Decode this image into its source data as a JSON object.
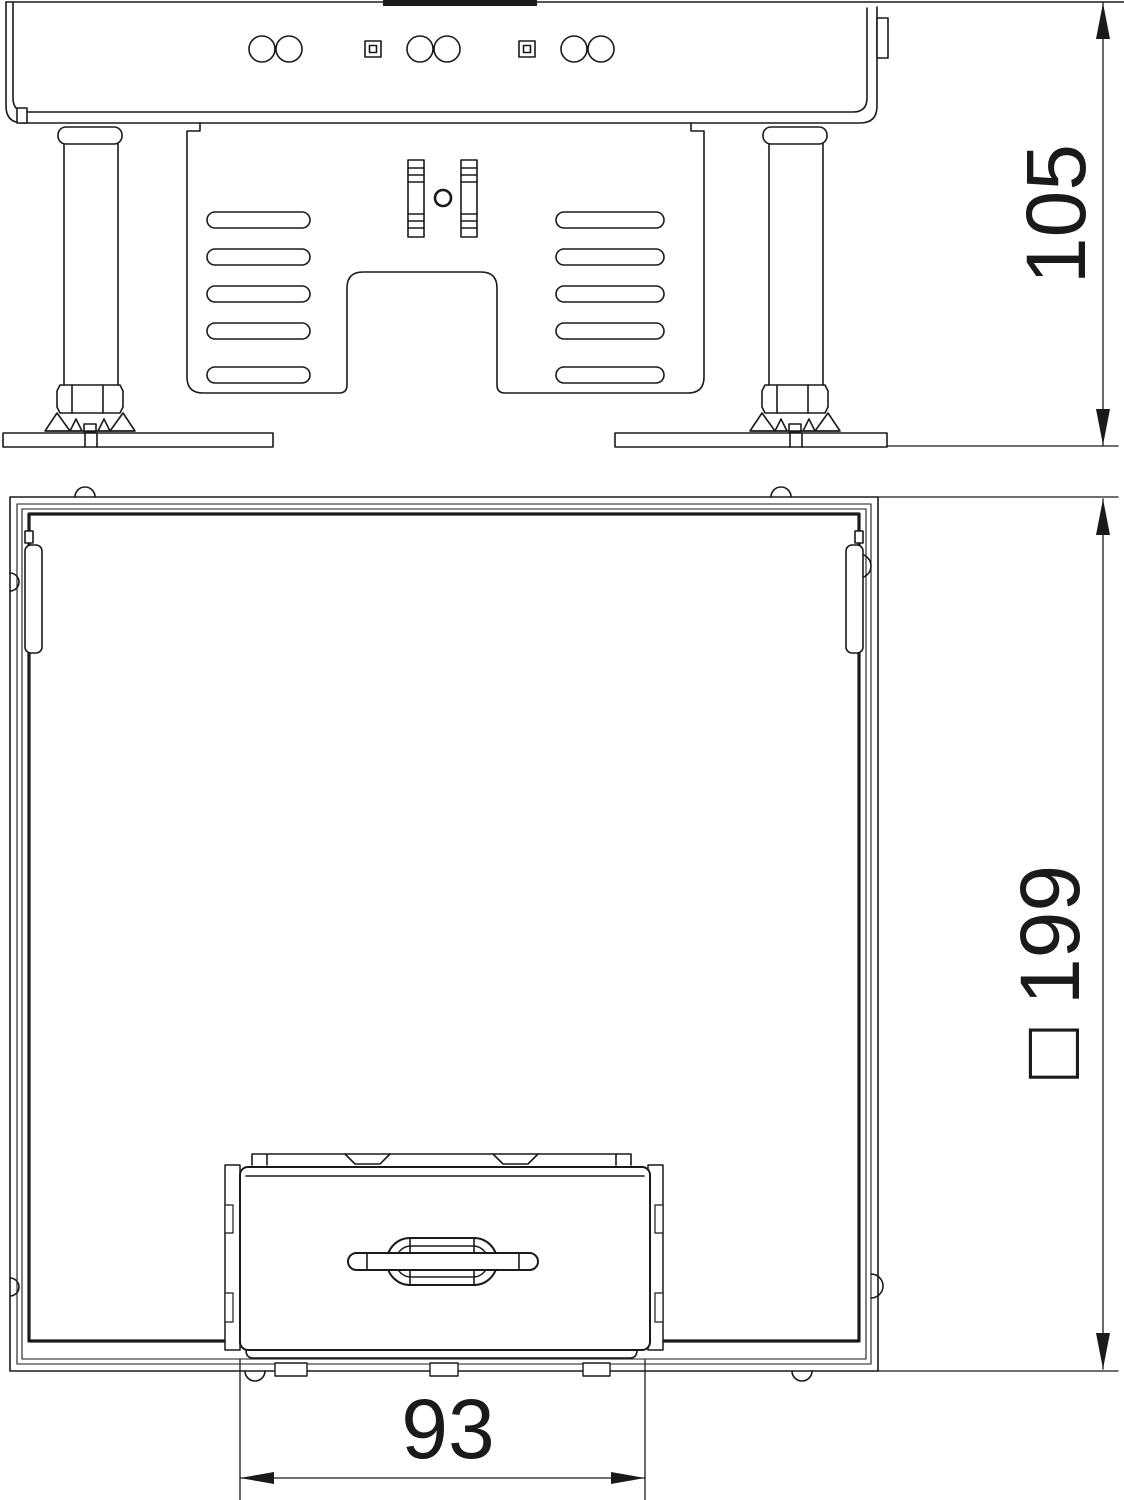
{
  "page": {
    "background": "#ffffff",
    "line_color": "#1a1a1a"
  },
  "drawing": {
    "type": "technical-dimension-drawing",
    "views": {
      "side_elevation": {
        "dimension_label": "105",
        "dimension_orientation": "vertical"
      },
      "plan_view": {
        "dimension_label": "□ 199",
        "dimension_orientation": "vertical",
        "insert_dimension_label": "93",
        "insert_dimension_orientation": "horizontal"
      }
    }
  }
}
